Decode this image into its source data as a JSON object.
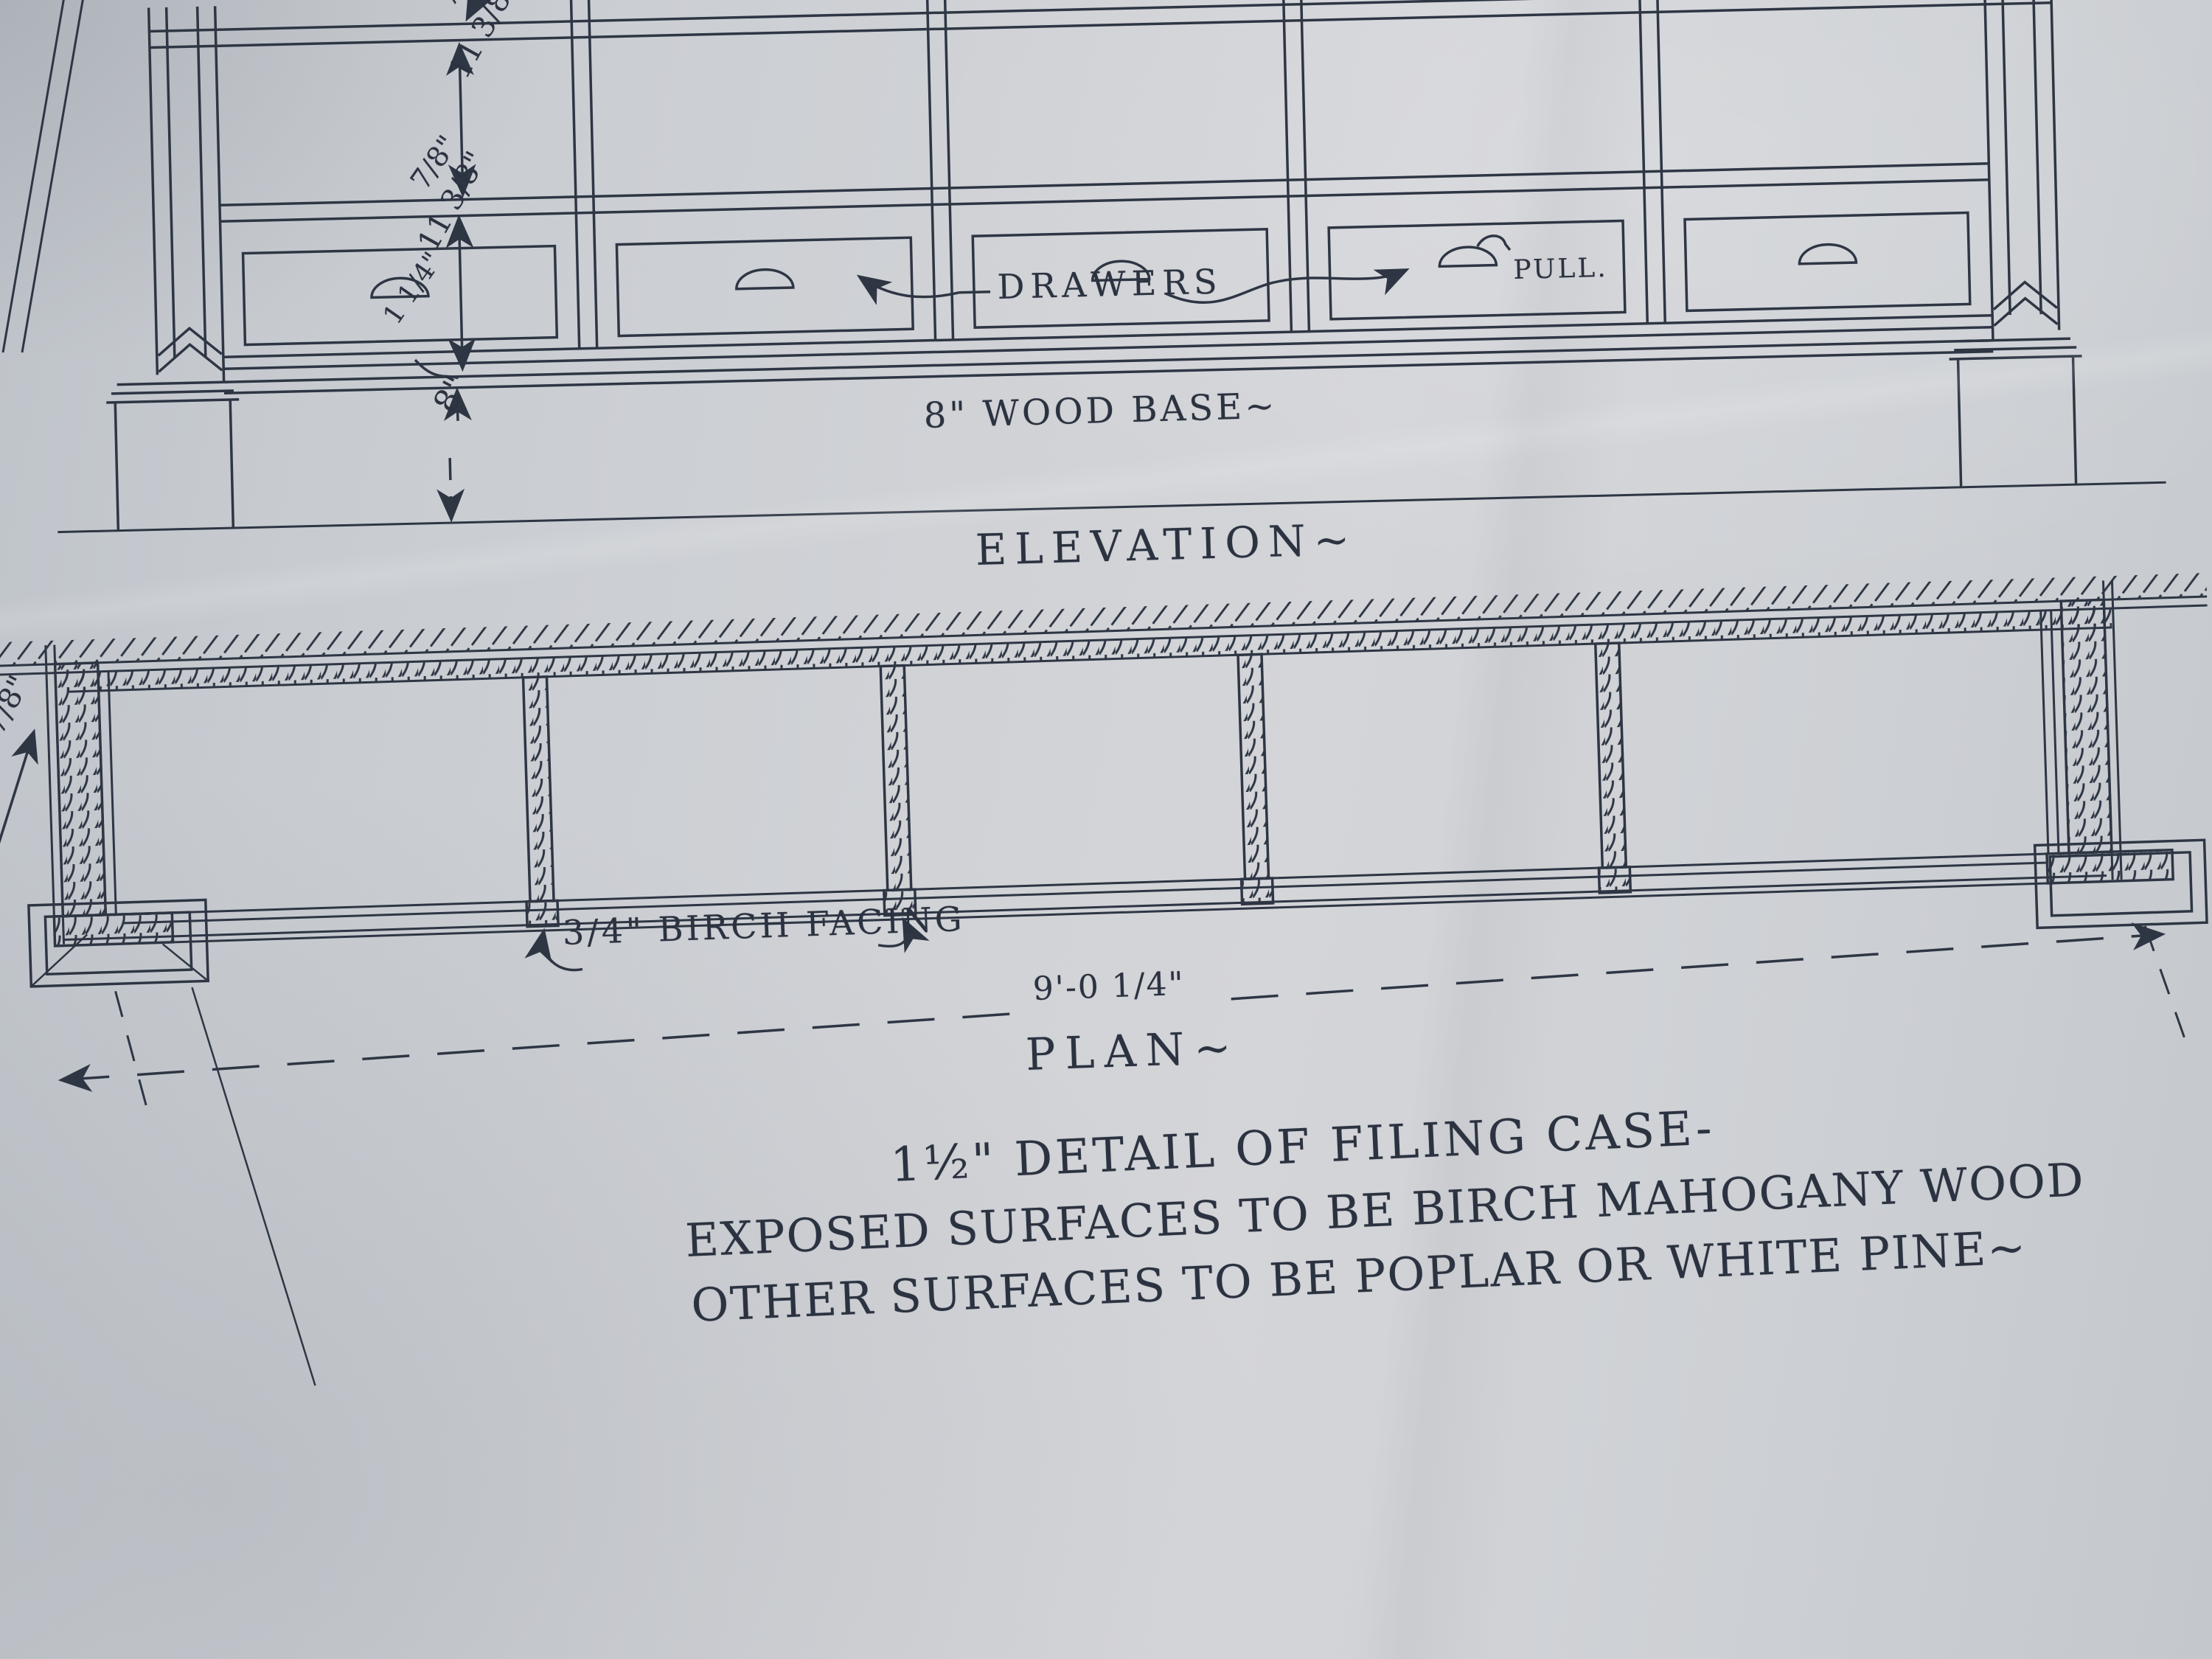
{
  "sheet": {
    "description": "Hand-drafted architectural millwork detail sheet, ink on gray drafting paper",
    "ink_color": "#2e3644",
    "paper_color": "#cdd0d4"
  },
  "elevation": {
    "title": "ELEVATION~",
    "labels": {
      "drawers": "DRAWERS",
      "pull": "PULL.",
      "wood_base": "8\" WOOD BASE~"
    },
    "dims": {
      "top_shelf_thickness": "7/8\"",
      "upper_opening": "11 3/8\"",
      "mid_shelf_thickness": "7/8\"",
      "drawer_opening": "11 3/8\"",
      "base_cap": "1 1/4\"",
      "base_height": "8\""
    }
  },
  "plan": {
    "title": "PLAN~",
    "labels": {
      "facing": "3/4\" BIRCH FACING",
      "overall_width": "9'-0 1/4\"",
      "left_partial_dim": "7/8\""
    }
  },
  "notes": {
    "scale_line": "1½\" DETAIL OF FILING CASE-",
    "materials_line1": "EXPOSED SURFACES TO BE BIRCH MAHOGANY WOOD",
    "materials_line2": "OTHER SURFACES TO BE POPLAR OR WHITE PINE~"
  }
}
